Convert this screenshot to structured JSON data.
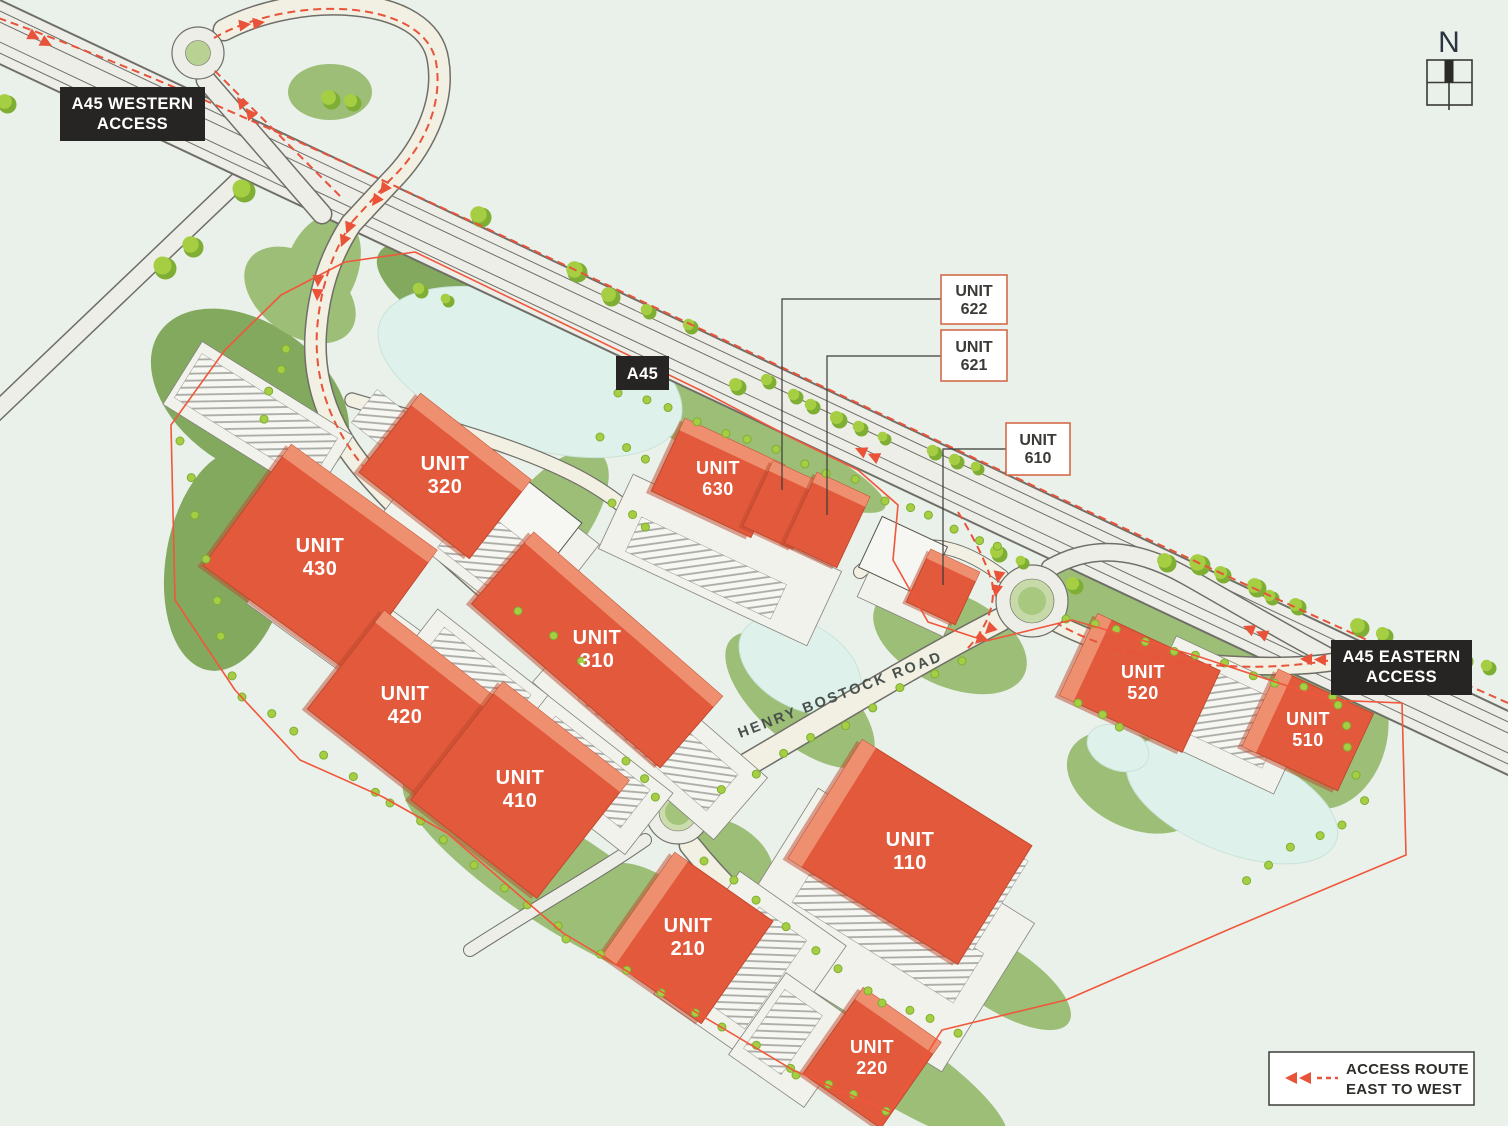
{
  "map": {
    "units": {
      "u110": {
        "l1": "UNIT",
        "l2": "110"
      },
      "u210": {
        "l1": "UNIT",
        "l2": "210"
      },
      "u220": {
        "l1": "UNIT",
        "l2": "220"
      },
      "u310": {
        "l1": "UNIT",
        "l2": "310"
      },
      "u320": {
        "l1": "UNIT",
        "l2": "320"
      },
      "u410": {
        "l1": "UNIT",
        "l2": "410"
      },
      "u420": {
        "l1": "UNIT",
        "l2": "420"
      },
      "u430": {
        "l1": "UNIT",
        "l2": "430"
      },
      "u510": {
        "l1": "UNIT",
        "l2": "510"
      },
      "u520": {
        "l1": "UNIT",
        "l2": "520"
      },
      "u630": {
        "l1": "UNIT",
        "l2": "630"
      }
    },
    "callouts": {
      "c622": {
        "l1": "UNIT",
        "l2": "622"
      },
      "c621": {
        "l1": "UNIT",
        "l2": "621"
      },
      "c610": {
        "l1": "UNIT",
        "l2": "610"
      }
    },
    "road_labels": {
      "a45": "A45",
      "western_l1": "A45 WESTERN",
      "western_l2": "ACCESS",
      "eastern_l1": "A45 EASTERN",
      "eastern_l2": "ACCESS",
      "street": "HENRY BOSTOCK ROAD"
    },
    "legend": {
      "l1": "ACCESS ROUTE",
      "l2": "EAST TO WEST"
    },
    "north_label": "N",
    "colors": {
      "background": "#E9F1EA",
      "building": "#E2593C",
      "building_light": "#EE9070",
      "green": "#9CBE77",
      "green_dark": "#83A95E",
      "pond": "#DFF1EB",
      "road": "#EDEEE8",
      "boundary_line": "#F0573B",
      "access_route": "#E8533A",
      "label_background": "#262523"
    }
  }
}
